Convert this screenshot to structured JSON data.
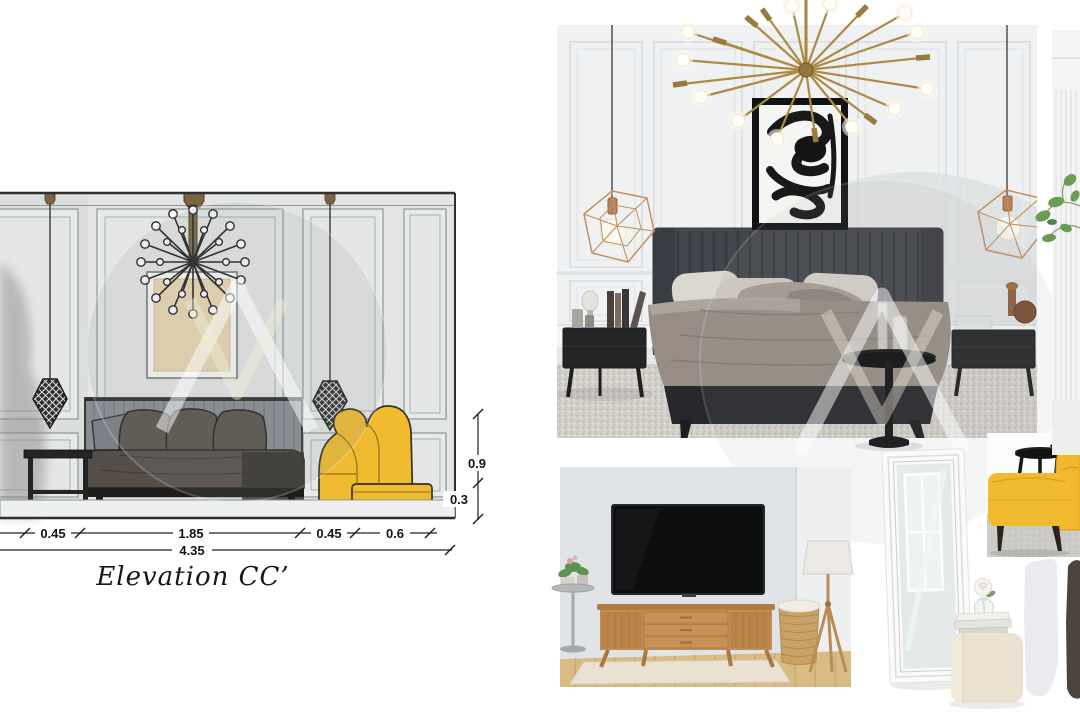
{
  "elevation": {
    "title": "Elevation CC’",
    "dims": {
      "d1": "0.45",
      "d2": "1.85",
      "d3": "0.45",
      "d4": "0.6",
      "total": "4.35",
      "v_upper": "0.9",
      "v_lower": "0.3"
    },
    "palette": {
      "wall": "#e2e5e3",
      "art_mat": "#e9d8b2",
      "headboard": "#898d94",
      "bedding": "#554e48",
      "armchair_yellow": "#f0bb2e",
      "line_ink": "#2a2a2a"
    }
  },
  "moodboard": {
    "items": [
      "sputnik-chandelier",
      "copper-geometric-pendant",
      "abstract-ink-art",
      "channel-tufted-headboard-bed",
      "black-nightstand",
      "textured-gray-rug",
      "black-pedestal-table",
      "wood-tv-console",
      "wall-tv",
      "tripod-floor-lamp",
      "wicker-basket",
      "white-floor-mirror",
      "yellow-leather-armchair",
      "yellow-ottoman",
      "black-nesting-tables",
      "cream-cube-pouf",
      "white-rose-vase",
      "stacked-books",
      "paint-swatches",
      "green-plant"
    ],
    "palette": {
      "brass": "#ab8843",
      "copper": "#c68f60",
      "charcoal": "#43464c",
      "taupe_bedding": "#978d84",
      "wood": "#c28b51",
      "accent_yellow": "#f2ba2e",
      "swatch_light": "#e9ebee",
      "swatch_dark": "#4d443d"
    }
  },
  "watermark": {
    "shape": "circle-monogram",
    "color": "#99a0a0"
  }
}
